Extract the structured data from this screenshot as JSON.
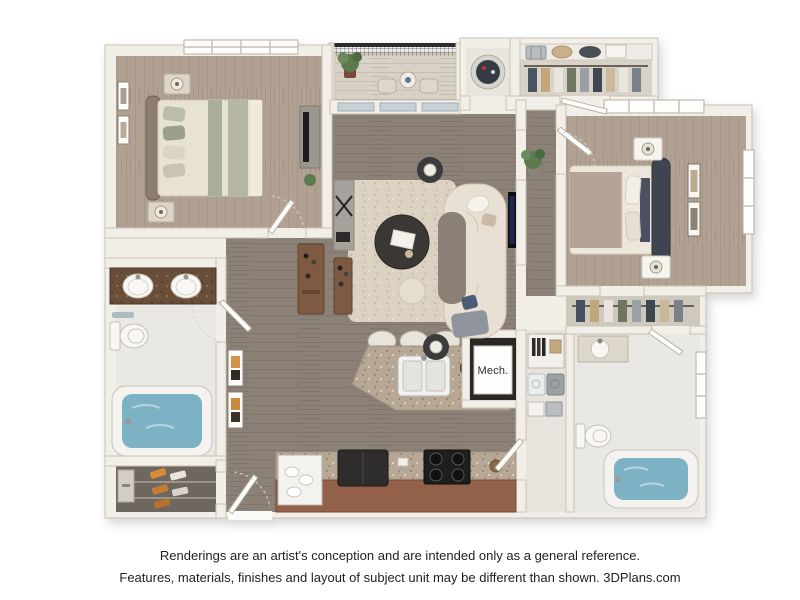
{
  "floor_plan": {
    "mech_label": "Mech.",
    "colors": {
      "wall": "#f2efe8",
      "wall_edge": "#c9c2b5",
      "floor_dark_wood": "#8b8177",
      "floor_light_wood": "#b1a192",
      "floor_tile": "#eae8e3",
      "floor_balcony": "#d8d2c6",
      "floor_closet": "#6e675f",
      "rug": "#dcd2c2",
      "sofa": "#e7e0d3",
      "coffee_table": "#3a3734",
      "granite_vanity": "#6b4e37",
      "granite_island": "#b7a795",
      "kitchen_cabinet": "#93604a",
      "appliance_dark": "#2e2d2c",
      "tub_water": "#7cb2c4",
      "railing": "#2c2c2c",
      "plant": "#5d7a4e",
      "fruit_red": "#bc2f3a",
      "bed1_stripe": "#a9ae98",
      "bed1_bedding": "#e8e2d2",
      "bed2_blanket": "#b5a495",
      "bed2_headboard": "#3f4450",
      "wood_console": "#7d5a41",
      "laundry_gray": "#9aa0a4",
      "art_orange": "#d3924a"
    }
  },
  "disclaimer": {
    "line1": "Renderings are an artist's conception and are intended only as a general reference.",
    "line2": "Features, materials, finishes and layout of subject unit may be different than shown. 3DPlans.com"
  }
}
